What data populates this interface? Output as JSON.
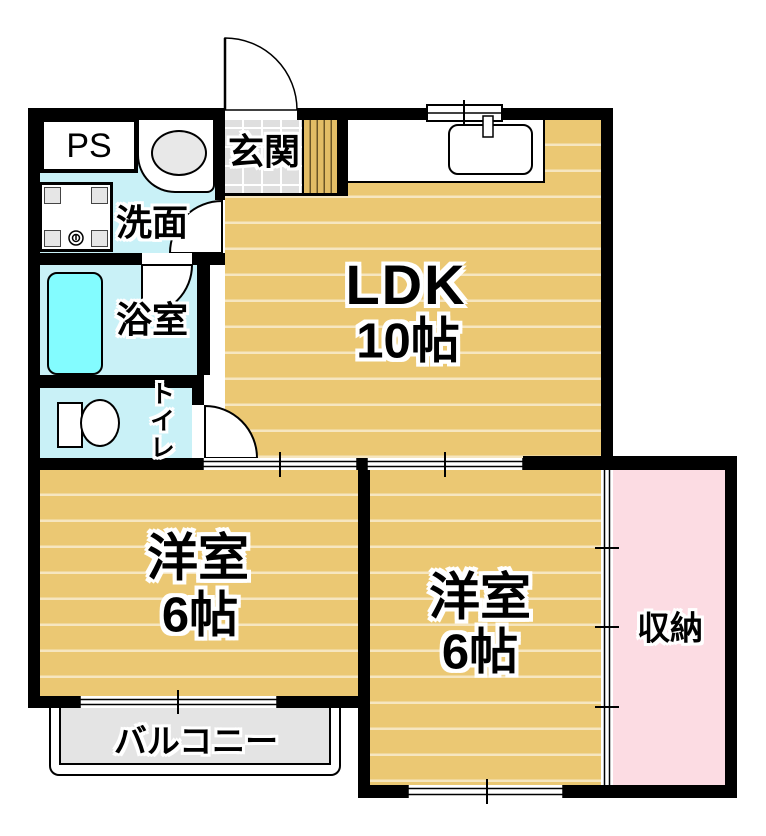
{
  "rooms": {
    "ldk": {
      "label": "LDK",
      "size": "10帖"
    },
    "bedroom_left": {
      "label": "洋室",
      "size": "6帖"
    },
    "bedroom_right": {
      "label": "洋室",
      "size": "6帖"
    },
    "entrance": {
      "label": "玄関"
    },
    "washroom": {
      "label": "洗面"
    },
    "bathroom": {
      "label": "浴室"
    },
    "toilet": {
      "label": "トイレ"
    },
    "pipe_space": {
      "label": "PS"
    },
    "storage": {
      "label": "収納"
    },
    "balcony": {
      "label": "バルコニー"
    }
  },
  "colors": {
    "wall": "#000000",
    "wood-floor": "#ebc873",
    "wood-stripe": "rgba(255,255,255,0.55)",
    "wet-floor": "#c9f1f7",
    "bathtub": "#83fcff",
    "storage-floor": "#fcdce3",
    "tile-floor": "#dfdfdf",
    "balcony-floor": "#e4e4e4",
    "step-wood": "#e3bd66",
    "step-line": "#6b5526"
  }
}
